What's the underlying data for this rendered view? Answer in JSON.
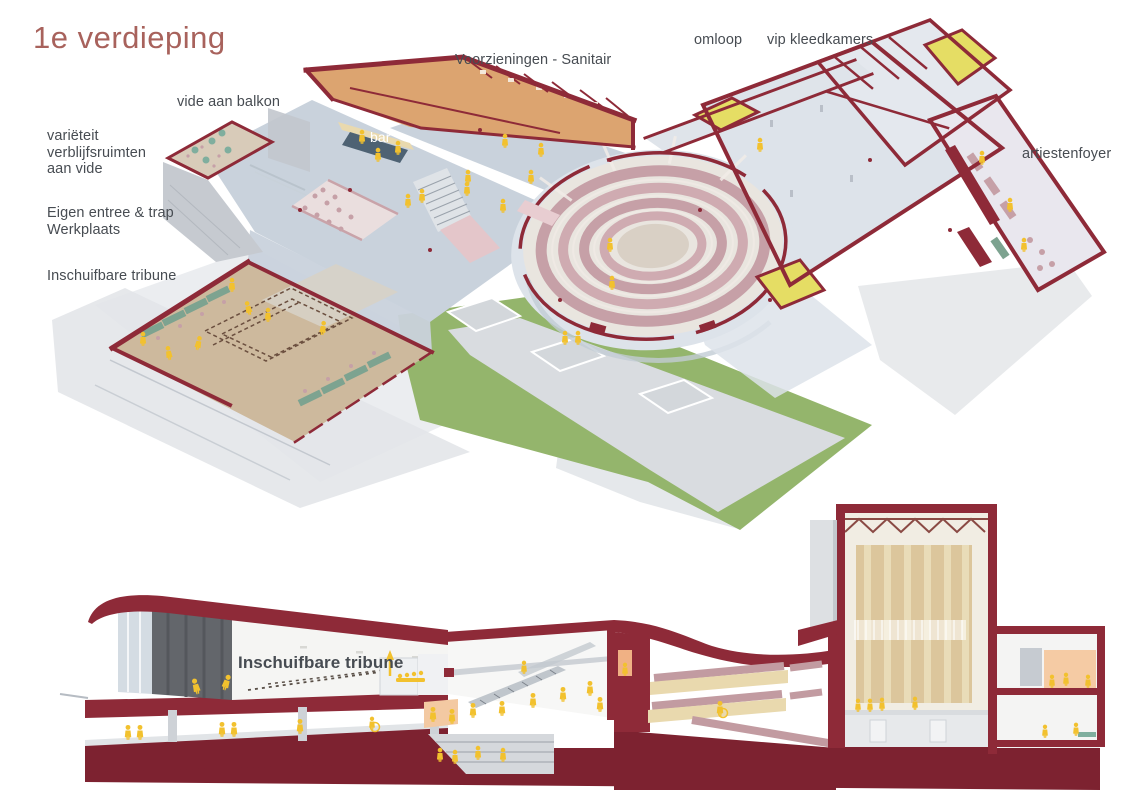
{
  "title": "1e verdieping",
  "plan": {
    "labels": {
      "vide_aan_balkon": "vide aan balkon",
      "varieteit_lines": [
        "variëteit",
        "verblijfsruimten",
        "aan vide"
      ],
      "eigen_entree_lines": [
        "Eigen entree & trap",
        "Werkplaats"
      ],
      "inschuifbare_tribune": "Inschuifbare tribune",
      "voorzieningen_sanitair": "Voorzieningen - Sanitair",
      "omloop": "omloop",
      "vip_kleedkamers": "vip kleedkamers",
      "artiestenfoyer": "artiestenfoyer",
      "bar": "bar"
    }
  },
  "section": {
    "labels": {
      "inschuifbare_tribune": "Inschuifbare tribune"
    }
  },
  "colors": {
    "title-color": "#a8625c",
    "label-color": "#474c52",
    "wall": "#8e2a38",
    "wall-dark": "#7d2230",
    "floor-blue": "#c9d2dc",
    "floor-blue-light": "#dde3ea",
    "floor-tan": "#cdb99d",
    "floor-orange": "#dca470",
    "green-roof": "#94b56c",
    "yellow-room": "#e5dd64",
    "person-yellow": "#f2c12e",
    "seat-pink": "#c6a0a7",
    "cream": "#e9d9ae",
    "concrete": "#d9dce0",
    "concrete-dark": "#bcc1c8",
    "glass": "#ccd6de",
    "dark-panel": "#63666b",
    "stage-tan": "#dcc69c",
    "bench-green": "#7da390"
  }
}
